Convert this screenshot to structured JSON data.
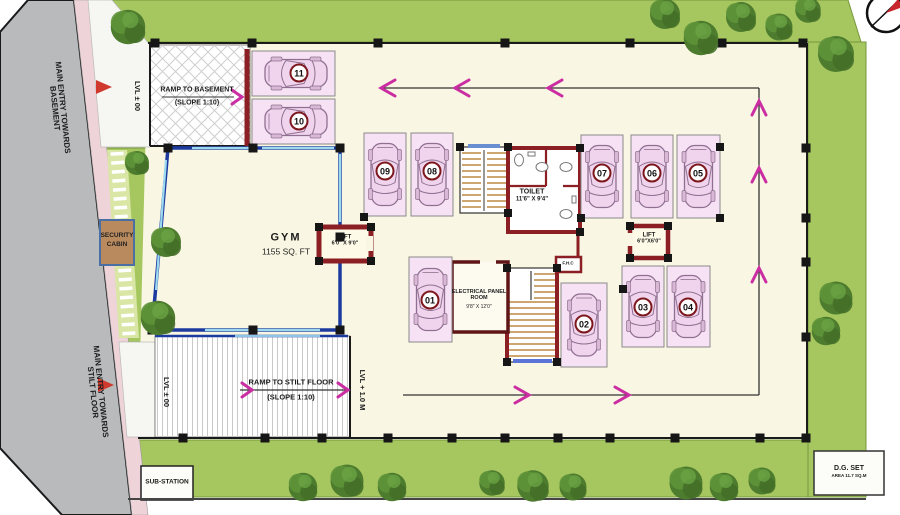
{
  "site": {
    "entry_basement_l1": "MAIN ENTRY TOWARDS",
    "entry_basement_l2": "BASEMENT",
    "entry_stilt_l1": "MAIN ENTRY TOWARDS",
    "entry_stilt_l2": "STILT FLOOR",
    "lvl_zero_top": "LVL ± 00",
    "lvl_zero_bottom": "LVL ± 00",
    "lvl_one": "LVL + 1.0 M",
    "substation": "SUB-STATION",
    "dg_set_l1": "D.G. SET",
    "dg_set_l2": "AREA 11.7 SQ.M",
    "security_l1": "SECURITY",
    "security_l2": "CABIN"
  },
  "ramps": {
    "basement_l1": "RAMP TO BASEMENT",
    "basement_l2": "(SLOPE 1:10)",
    "stilt_l1": "RAMP TO STILT FLOOR",
    "stilt_l2": "(SLOPE 1:10)"
  },
  "rooms": {
    "gym_name": "GYM",
    "gym_area": "1155 SQ. FT",
    "lift_main_name": "LIFT",
    "lift_main_size": "6'0\" X 9'0\"",
    "lift_service_name": "LIFT",
    "lift_service_size": "6'0\"X6'0\"",
    "toilet_name": "TOILET",
    "toilet_size": "11'6\" X 9'4\"",
    "electrical_l1": "ELECTRICAL PANEL",
    "electrical_l2": "ROOM",
    "electrical_size": "9'8\" X 12'0\"",
    "fhc": "F.H.C"
  },
  "parking": {
    "stalls": [
      {
        "number": "01"
      },
      {
        "number": "02"
      },
      {
        "number": "03"
      },
      {
        "number": "04"
      },
      {
        "number": "05"
      },
      {
        "number": "06"
      },
      {
        "number": "07"
      },
      {
        "number": "08"
      },
      {
        "number": "09"
      },
      {
        "number": "10"
      },
      {
        "number": "11"
      }
    ]
  },
  "colors": {
    "grass": "#a6c75f",
    "road": "#b9babc",
    "floor": "#f9f7e3",
    "stall_fill": "#f6e2f4",
    "wall_maroon": "#8b1f24",
    "wall_blue": "#1c3aa0",
    "arrow_magenta": "#cb2da2",
    "entry_arrow_red": "#d03a2e"
  }
}
